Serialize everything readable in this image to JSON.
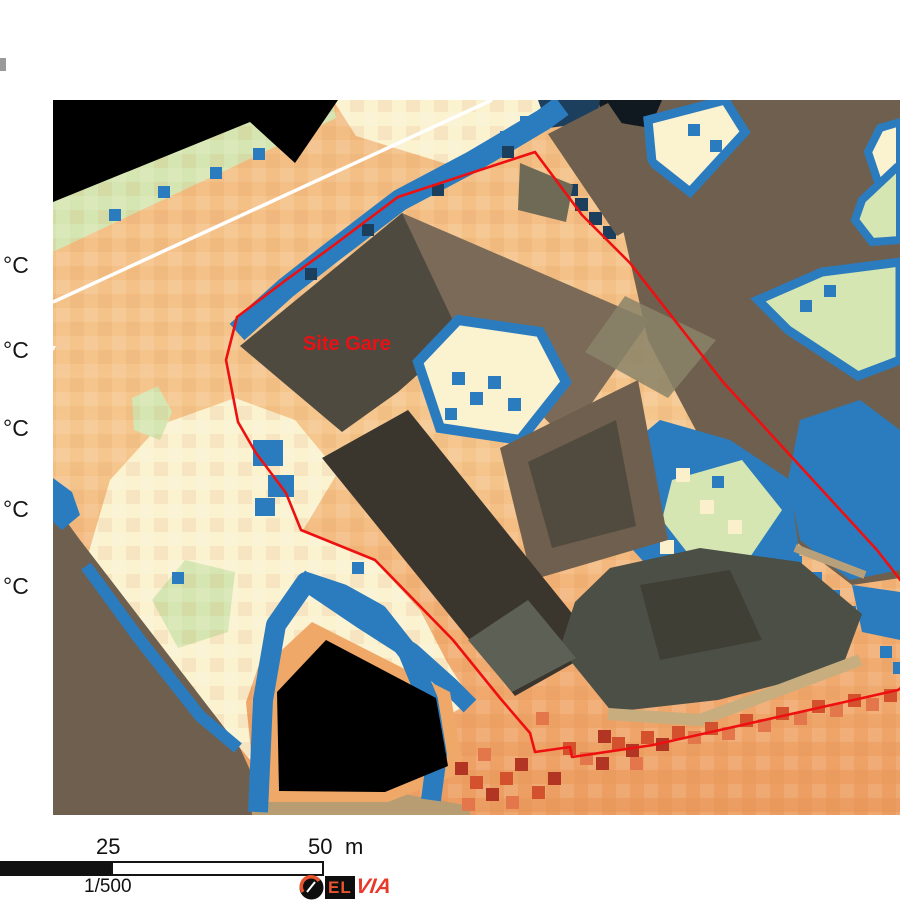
{
  "legend": {
    "unit_labels": [
      "°C",
      "°C",
      "°C",
      "°C",
      "°C"
    ]
  },
  "map": {
    "site_label": "Site Gare",
    "road_label_fragment": "y",
    "palette": {
      "ground": "#f3bd83",
      "ground_deep": "#ec9c60",
      "cream": "#fbf2d0",
      "green": "#d6e6b2",
      "blue": "#2b7cbe",
      "navy": "#1c3f5e",
      "brown": "#6f5f4e",
      "tan": "#b99d72",
      "building_dark": "#4e4a3f",
      "building_darker": "#3a362e",
      "building_mid": "#7b6a57",
      "building_gray": "#4b4f46",
      "olive": "#8a8468",
      "no_data_black": "#000000",
      "site_outline_red": "#ee1010",
      "hot_red": "#b23524",
      "road_white": "#ffffff"
    }
  },
  "scale_bar": {
    "mid_label": "25",
    "end_label": "50",
    "unit_label": "m",
    "ratio_label": "1/500"
  },
  "logo": {
    "box_text": "EL",
    "accent_text": "VIA"
  }
}
